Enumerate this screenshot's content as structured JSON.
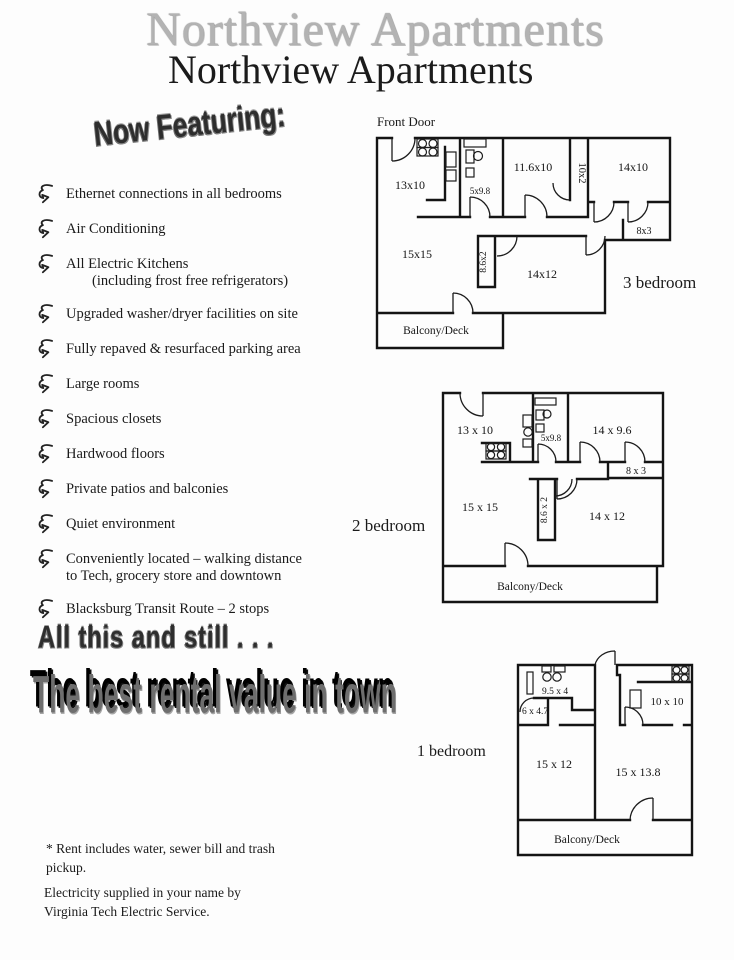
{
  "page": {
    "title_outline": "Northview Apartments",
    "title_solid": "Northview Apartments",
    "now_featuring": "Now Featuring:",
    "tagline1": "All this and still . . .",
    "tagline2": "The best rental value in town",
    "footnote_rent": "* Rent includes water, sewer bill and trash pickup.",
    "footnote_electric": "Electricity supplied in your name by Virginia Tech Electric Service."
  },
  "features": [
    {
      "line1": "Ethernet connections in all bedrooms"
    },
    {
      "line1": "Air Conditioning"
    },
    {
      "line1": "All Electric Kitchens",
      "line2": "(including frost free refrigerators)"
    },
    {
      "line1": "Upgraded washer/dryer facilities on site"
    },
    {
      "line1": "Fully repaved & resurfaced parking area"
    },
    {
      "line1": "Large rooms"
    },
    {
      "line1": "Spacious closets"
    },
    {
      "line1": "Hardwood floors"
    },
    {
      "line1": "Private patios and balconies"
    },
    {
      "line1": "Quiet environment"
    },
    {
      "line1": "Conveniently located – walking distance",
      "line2": "to Tech, grocery store and downtown"
    },
    {
      "line1": "Blacksburg Transit Route – 2 stops"
    }
  ],
  "plans": {
    "p3": {
      "label": "3 bedroom",
      "front_door": "Front Door",
      "rooms": {
        "r1": "13x10",
        "bath": "5x9.8",
        "r2": "11.6x10",
        "c1": "10x2",
        "r3": "14x10",
        "c2": "8x3",
        "living": "15x15",
        "c3": "8.6x2",
        "r4": "14x12",
        "balcony": "Balcony/Deck"
      }
    },
    "p2": {
      "label": "2 bedroom",
      "rooms": {
        "r1": "13 x 10",
        "bath": "5x9.8",
        "r2": "14 x 9.6",
        "c1": "8 x 3",
        "living": "15 x 15",
        "c2": "8.6 x 2",
        "r3": "14 x 12",
        "balcony": "Balcony/Deck"
      }
    },
    "p1": {
      "label": "1 bedroom",
      "rooms": {
        "kitchen": "9.5 x 4",
        "bath": "6 x 4.7",
        "r1": "10 x 10",
        "r2": "15 x 12",
        "living": "15 x 13.8",
        "balcony": "Balcony/Deck"
      }
    }
  },
  "colors": {
    "ink": "#1a1a1a",
    "paper": "#fdfdfd",
    "title_gray": "#b3b3b3"
  }
}
